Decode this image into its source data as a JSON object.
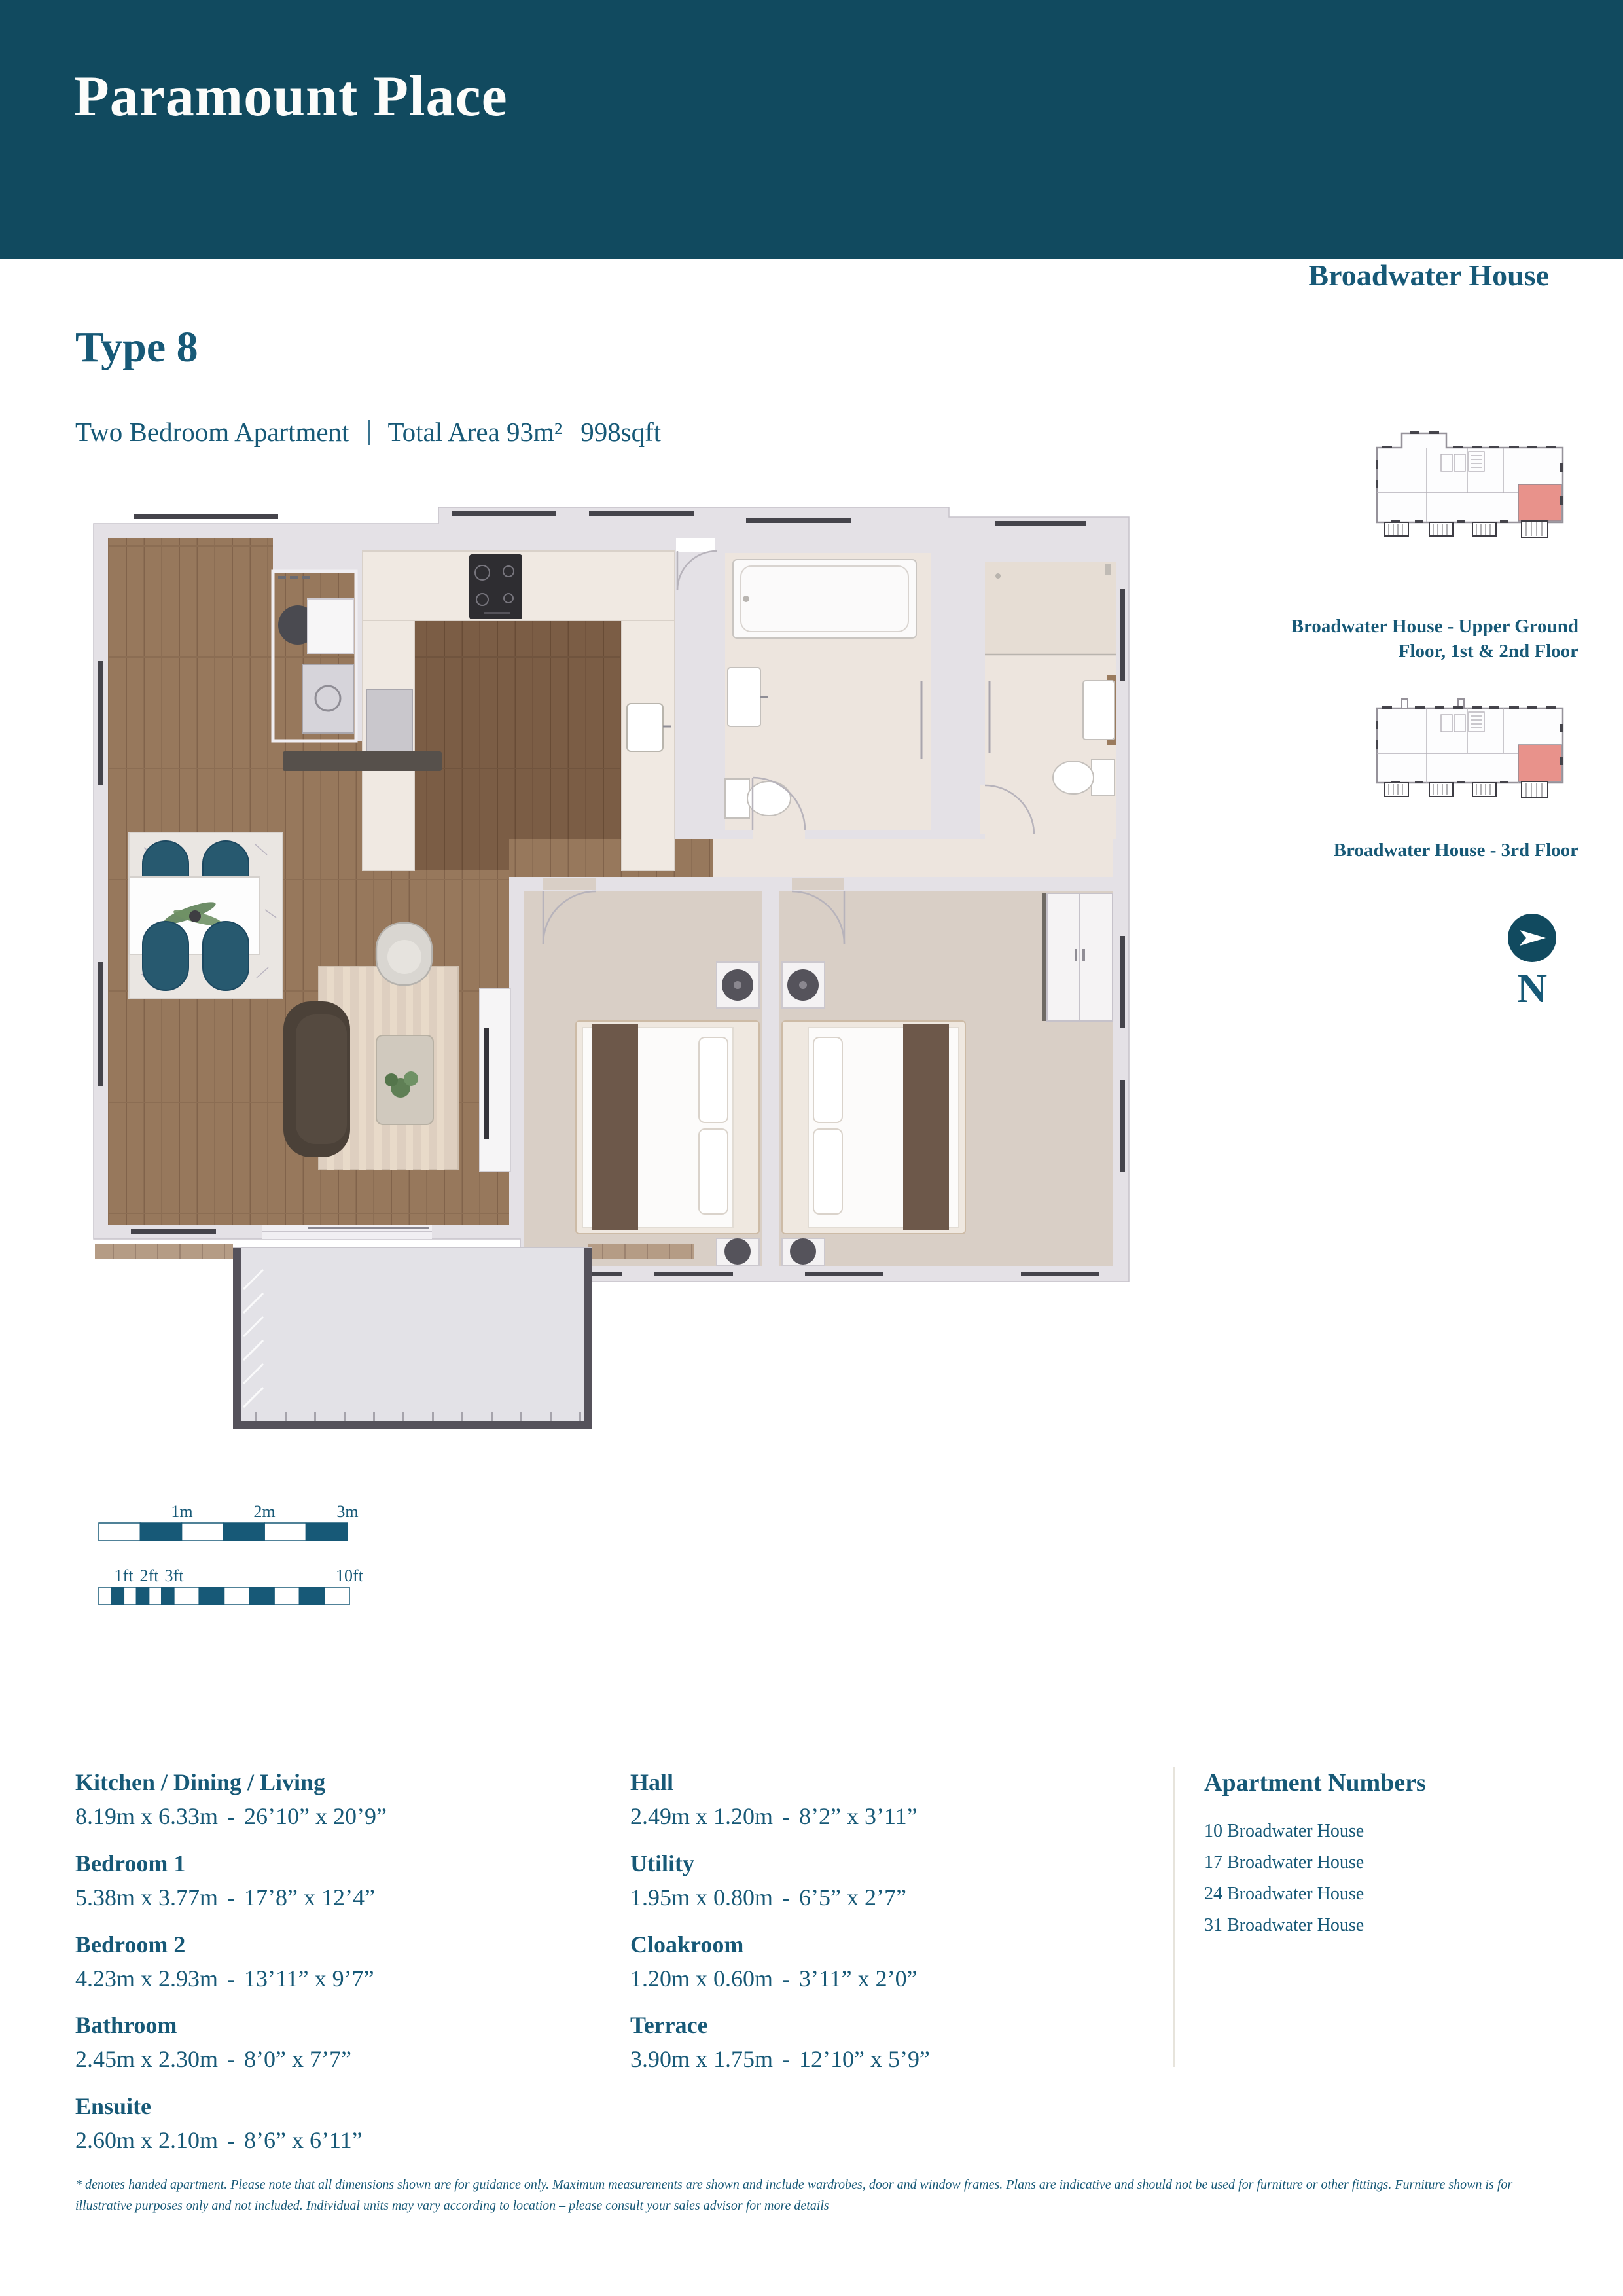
{
  "colors": {
    "teal_banner": "#114A5F",
    "teal_text": "#175977",
    "highlight_pink": "#E8928B",
    "wall_gray": "#E4E1E6",
    "wood": "#97785C",
    "carpet": "#D9CFC6"
  },
  "banner": {
    "title": "Paramount Place"
  },
  "header": {
    "type_title": "Type 8",
    "apartment_type": "Two Bedroom Apartment",
    "total_area": "Total Area 93m²",
    "sqft": "998sqft"
  },
  "right_panel": {
    "building_title": "Broadwater House",
    "upper_caption_line1": "Broadwater House - Upper Ground",
    "upper_caption_line2": "Floor, 1st & 2nd Floor",
    "third_caption": "Broadwater House - 3rd Floor",
    "north_label": "N"
  },
  "scale": {
    "m1": "1m",
    "m2": "2m",
    "m3": "3m",
    "f1": "1ft",
    "f2": "2ft",
    "f3": "3ft",
    "f10": "10ft"
  },
  "rooms": [
    {
      "name": "Kitchen / Dining / Living",
      "metric": "8.19m x 6.33m",
      "imperial": "26’10” x 20’9”"
    },
    {
      "name": "Bedroom 1",
      "metric": "5.38m x 3.77m",
      "imperial": "17’8” x 12’4”"
    },
    {
      "name": "Bedroom 2",
      "metric": "4.23m x 2.93m",
      "imperial": "13’11” x 9’7”"
    },
    {
      "name": "Bathroom",
      "metric": "2.45m x 2.30m",
      "imperial": "8’0” x 7’7”"
    },
    {
      "name": "Ensuite",
      "metric": "2.60m x 2.10m",
      "imperial": "8’6” x 6’11”"
    },
    {
      "name": "Hall",
      "metric": "2.49m x 1.20m",
      "imperial": "8’2” x 3’11”"
    },
    {
      "name": "Utility",
      "metric": "1.95m x 0.80m",
      "imperial": "6’5” x 2’7”"
    },
    {
      "name": "Cloakroom",
      "metric": "1.20m x 0.60m",
      "imperial": "3’11” x 2’0”"
    },
    {
      "name": "Terrace",
      "metric": "3.90m x 1.75m",
      "imperial": "12’10” x 5’9”"
    }
  ],
  "apartments": {
    "title": "Apartment Numbers",
    "items": [
      "10 Broadwater House",
      "17 Broadwater House",
      "24 Broadwater House",
      "31 Broadwater House"
    ]
  },
  "footnote": "* denotes handed apartment. Please note that all dimensions shown are for guidance only. Maximum measurements are shown and include wardrobes, door and window frames. Plans are indicative and should not be used for furniture or other fittings. Furniture shown is for illustrative purposes only and not included. Individual units may vary according to location – please consult your sales advisor for more details"
}
